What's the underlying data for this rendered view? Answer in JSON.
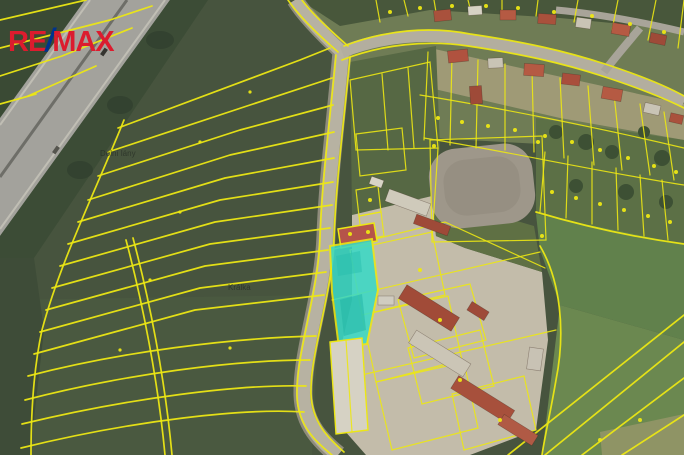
{
  "canvas": {
    "width": 684,
    "height": 455
  },
  "logo": {
    "re": "RE",
    "slash": "/",
    "max": "MAX",
    "color_red": "#DC1C2E",
    "color_blue": "#00338D"
  },
  "map": {
    "kind": "aerial-cadastral-map",
    "labels": [
      {
        "text": "Dolní lány"
      },
      {
        "text": "Králka"
      }
    ],
    "colors": {
      "parcel_line": "#ECE714",
      "highlight_fill": "#3BD9C6",
      "highlight_building": "#B5544A",
      "field_dark": "#47543E",
      "trees": "#36452F",
      "highway": "#A3A29C",
      "road": "#B7B2A2",
      "dirt_oval": "#9E978A",
      "meadow": "#5C7046",
      "bright_field": "#61814C",
      "farm_yard": "#C3BCAA"
    }
  }
}
